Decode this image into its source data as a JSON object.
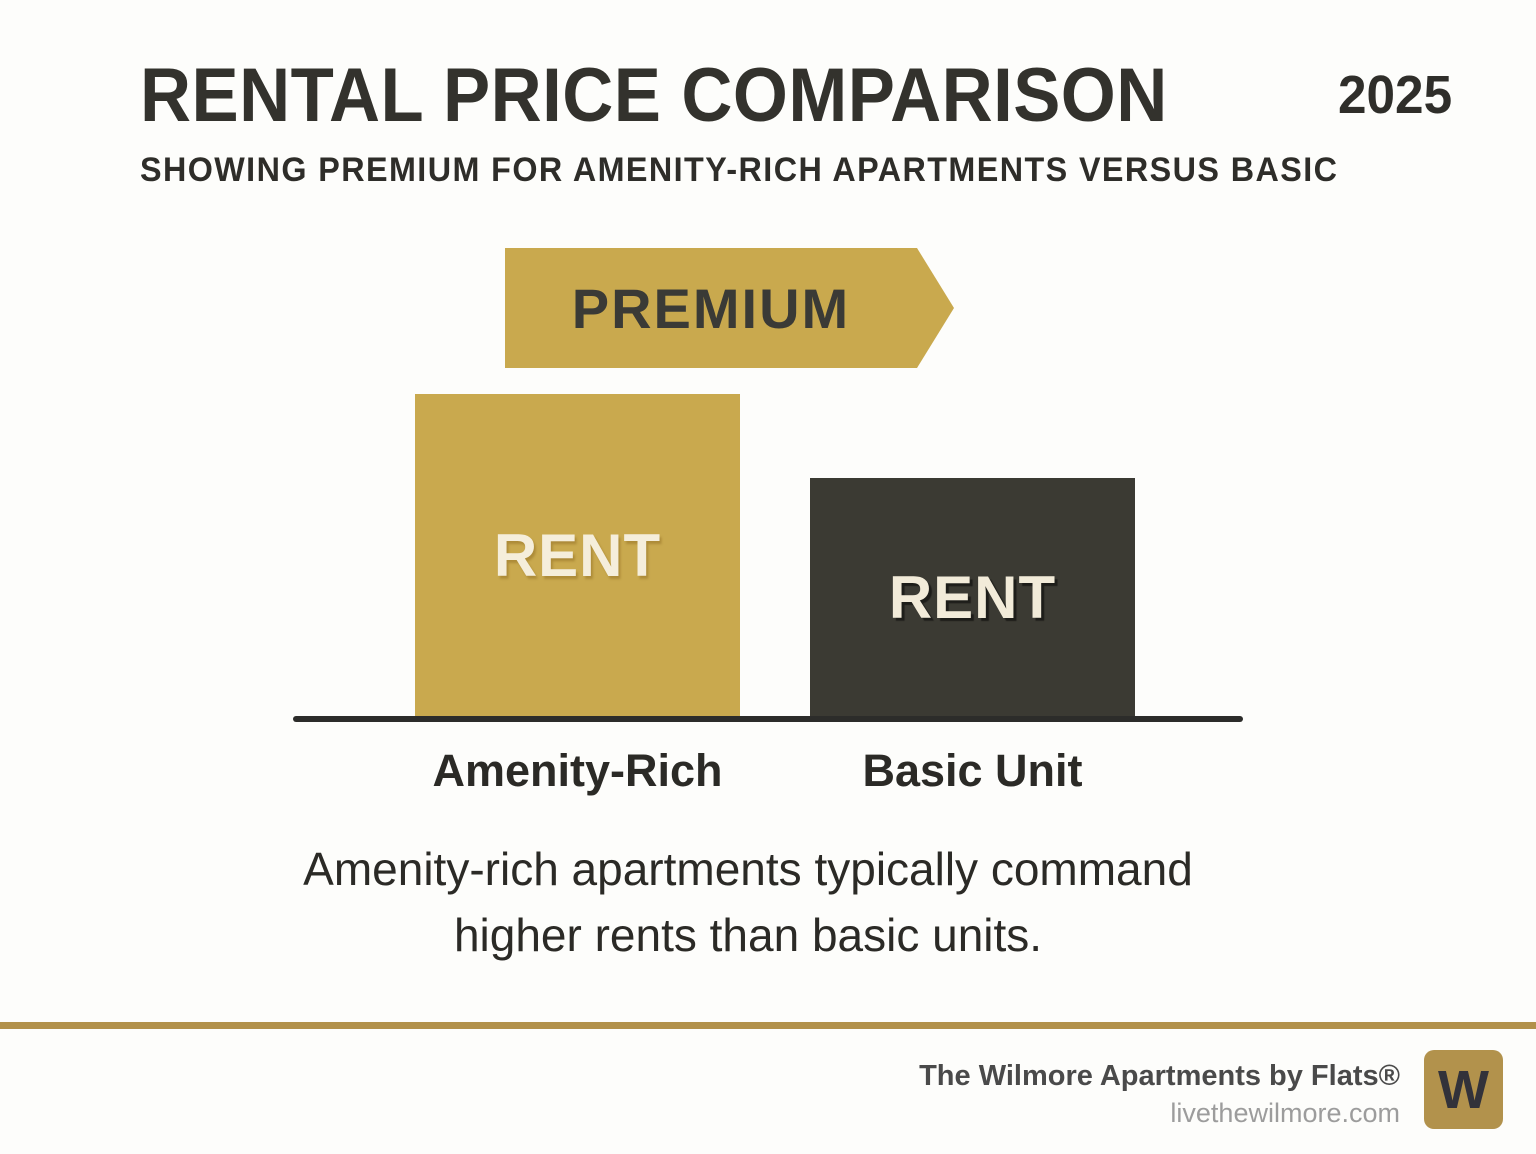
{
  "header": {
    "title": "RENTAL PRICE COMPARISON",
    "year": "2025",
    "subtitle": "SHOWING PREMIUM FOR AMENITY-RICH APARTMENTS VERSUS BASIC"
  },
  "chart_data": {
    "type": "bar",
    "title": "RENTAL PRICE COMPARISON",
    "subtitle": "SHOWING PREMIUM FOR AMENITY-RICH APARTMENTS VERSUS BASIC",
    "year": "2025",
    "categories": [
      "Amenity-Rich",
      "Basic Unit"
    ],
    "series": [
      {
        "name": "Rent",
        "values": [
          100,
          74
        ]
      }
    ],
    "value_scale": "relative bar height as percent of tallest bar; chart shows no numeric axis or tick labels",
    "bar_text_labels": [
      "RENT",
      "RENT"
    ],
    "bar_colors": [
      "#c9a94e",
      "#3b3a33"
    ],
    "annotation_arrow": {
      "label": "PREMIUM",
      "color": "#c9a94e",
      "points": "right",
      "position": "above Amenity-Rich bar"
    },
    "axes": {
      "x": "category labels below baseline",
      "y": "none"
    },
    "gridlines": false,
    "legend": "none"
  },
  "caption": {
    "line1": "Amenity-rich apartments typically command",
    "line2": "higher rents than basic units."
  },
  "footer": {
    "brand": "The Wilmore Apartments by Flats®",
    "url": "livethewilmore.com",
    "logo_letter": "W"
  },
  "colors": {
    "background": "#fdfdfb",
    "gold": "#c9a94e",
    "dark_bar": "#3b3a33",
    "cream_text": "#f5eedb",
    "baseline": "#2c2c2a",
    "footer_rule_gold": "#b2914a",
    "logo_gold": "#b2924c",
    "text_dark": "#33322d"
  }
}
